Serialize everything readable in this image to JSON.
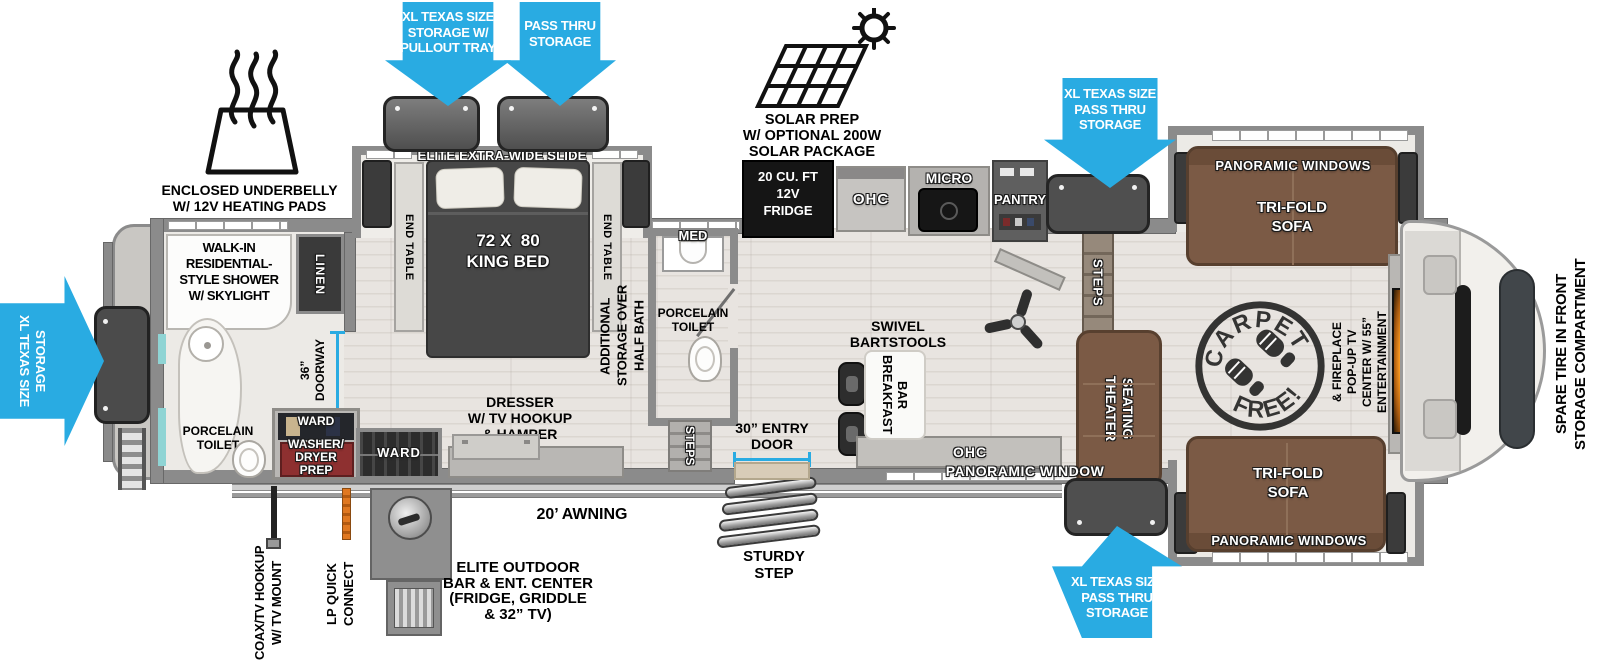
{
  "arrows": {
    "storage_pullout": "XL TEXAS SIZE\nSTORAGE W/\nPULLOUT TRAY",
    "pass_thru": "PASS THRU\nSTORAGE",
    "front_upper": "XL TEXAS SIZE\nPASS THRU\nSTORAGE",
    "rear": "XL TEXAS SIZE\nSTORAGE",
    "front_lower": "XL TEXAS SIZE\nPASS THRU\nSTORAGE"
  },
  "exterior": {
    "underbelly": "ENCLOSED UNDERBELLY\nW/ 12V HEATING PADS",
    "solar": "SOLAR PREP\nW/ OPTIONAL 200W\nSOLAR PACKAGE",
    "awning": "20’ AWNING",
    "outdoor_bar": "ELITE OUTDOOR\nBAR & ENT. CENTER\n(FRIDGE, GRIDDLE\n& 32” TV)",
    "sturdy_step": "STURDY\nSTEP",
    "coax": "COAX/TV HOOKUP\nW/ TV MOUNT",
    "lp_quick": "LP QUICK\nCONNECT",
    "spare_tire": "SPARE TIRE IN FRONT\nSTORAGE COMPARTMENT"
  },
  "bedroom": {
    "slide": "ELITE EXTRA-WIDE SLIDE",
    "end_table_left": "END TABLE",
    "end_table_right": "END TABLE",
    "bed": "72 X  80\nKING BED",
    "dresser": "DRESSER\nW/ TV HOOKUP\n& HAMPER",
    "ward": "WARD"
  },
  "rear_bath": {
    "shower": "WALK-IN\nRESIDENTIAL-\nSTYLE SHOWER\nW/ SKYLIGHT",
    "linen": "LINEN",
    "doorway": "36”\nDOORWAY",
    "toilet": "PORCELAIN\nTOILET",
    "ward": "WARD",
    "washer": "WASHER/\nDRYER\nPREP"
  },
  "half_bath": {
    "overhead": "ADDITIONAL\nSTORAGE OVER\nHALF BATH",
    "med": "MED",
    "toilet": "PORCELAIN\nTOILET",
    "steps": "STEPS"
  },
  "kitchen": {
    "fridge": "20 CU. FT\n12V\nFRIDGE",
    "ohc": "OHC",
    "micro": "MICRO",
    "pantry": "PANTRY",
    "stools": "SWIVEL\nBARTSTOOLS",
    "bar": "BREAKFAST\nBAR",
    "entry": "30” ENTRY\nDOOR",
    "ohc_lower": "OHC",
    "window": "PANORAMIC WINDOW"
  },
  "living": {
    "steps": "STEPS",
    "theater": "THEATER\nSEATING",
    "carpet_top": "CARPET",
    "carpet_bottom": "FREE!",
    "sofa_upper": "TRI-FOLD\nSOFA",
    "windows_upper": "PANORAMIC WINDOWS",
    "sofa_lower": "TRI-FOLD\nSOFA",
    "windows_lower": "PANORAMIC WINDOWS",
    "entertainment": "ENTERTAINMENT\nCENTER W/ 55”\nPOP-UP TV\n& FIREPLACE"
  },
  "colors": {
    "arrow_blue": "#29abe2",
    "sofa_brown": "#7b5a45",
    "wall_gray": "#8b8b8b",
    "fireplace_orange": "#f5941e"
  }
}
